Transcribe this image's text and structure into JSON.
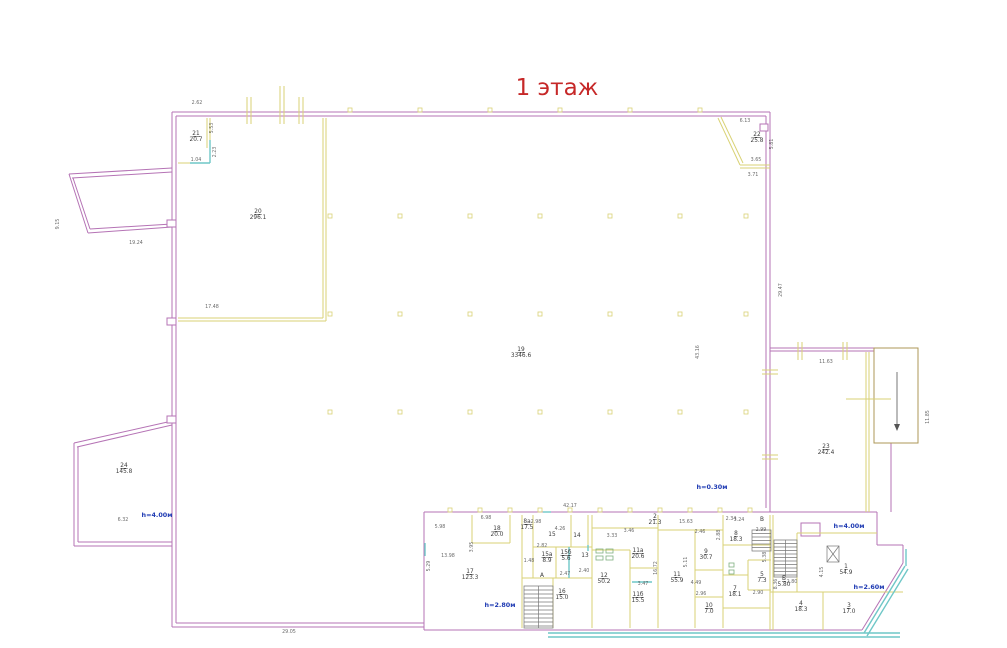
{
  "title": "1 этаж",
  "colors": {
    "title": "#c62828",
    "walls_outer": "#b573b5",
    "walls_inner": "#d9d275",
    "glazing": "#6fc7c7",
    "ramp": "#ad9757",
    "fixtures": "#7fb07f",
    "height_notes": "#1f3bb3",
    "dimensions": "#6a6a6a"
  },
  "floor_plan": {
    "rooms": [
      {
        "id": "19",
        "area": "3346.6",
        "x": 521,
        "y": 351
      },
      {
        "id": "20",
        "area": "296.1",
        "x": 258,
        "y": 213
      },
      {
        "id": "21",
        "area": "20.7",
        "x": 196,
        "y": 135
      },
      {
        "id": "22",
        "area": "25.8",
        "x": 757,
        "y": 136
      },
      {
        "id": "23",
        "area": "242.4",
        "x": 826,
        "y": 448
      },
      {
        "id": "24",
        "area": "145.8",
        "x": 124,
        "y": 467
      },
      {
        "id": "17",
        "area": "123.3",
        "x": 470,
        "y": 573
      },
      {
        "id": "18",
        "area": "20.0",
        "x": 497,
        "y": 530
      },
      {
        "id": "8а",
        "area": "17.5",
        "x": 527,
        "y": 523
      },
      {
        "id": "15",
        "area": "",
        "x": 552,
        "y": 536
      },
      {
        "id": "14",
        "area": "",
        "x": 577,
        "y": 537
      },
      {
        "id": "15а",
        "area": "8.9",
        "x": 547,
        "y": 556
      },
      {
        "id": "15б",
        "area": "5.6",
        "x": 566,
        "y": 554
      },
      {
        "id": "13",
        "area": "",
        "x": 585,
        "y": 557
      },
      {
        "id": "16",
        "area": "15.0",
        "x": 562,
        "y": 593
      },
      {
        "id": "12",
        "area": "50.2",
        "x": 604,
        "y": 577
      },
      {
        "id": "11б",
        "area": "15.5",
        "x": 638,
        "y": 596
      },
      {
        "id": "11а",
        "area": "20.6",
        "x": 638,
        "y": 552
      },
      {
        "id": "11",
        "area": "55.9",
        "x": 677,
        "y": 576
      },
      {
        "id": "9",
        "area": "30.7",
        "x": 706,
        "y": 553
      },
      {
        "id": "10",
        "area": "7.0",
        "x": 709,
        "y": 607
      },
      {
        "id": "7",
        "area": "18.1",
        "x": 735,
        "y": 590
      },
      {
        "id": "2",
        "area": "21.3",
        "x": 655,
        "y": 518
      },
      {
        "id": "8",
        "area": "18.3",
        "x": 736,
        "y": 535
      },
      {
        "id": "5",
        "area": "7.3",
        "x": 762,
        "y": 576
      },
      {
        "id": "4",
        "area": "18.3",
        "x": 801,
        "y": 605
      },
      {
        "id": "3",
        "area": "17.0",
        "x": 849,
        "y": 607
      },
      {
        "id": "1",
        "area": "54.9",
        "x": 846,
        "y": 568
      },
      {
        "id": "А",
        "area": "",
        "x": 542,
        "y": 577
      },
      {
        "id": "Б",
        "area": "5.80",
        "x": 784,
        "y": 580
      },
      {
        "id": "В",
        "area": "",
        "x": 762,
        "y": 521
      }
    ],
    "dimensions": [
      {
        "t": "6.13",
        "x": 745,
        "y": 122
      },
      {
        "t": "5.81",
        "x": 773,
        "y": 144,
        "r": -90
      },
      {
        "t": "3.65",
        "x": 756,
        "y": 161
      },
      {
        "t": "3.71",
        "x": 753,
        "y": 176
      },
      {
        "t": "29.47",
        "x": 782,
        "y": 290,
        "r": -90
      },
      {
        "t": "11.63",
        "x": 826,
        "y": 363
      },
      {
        "t": "11.85",
        "x": 929,
        "y": 417,
        "r": -90
      },
      {
        "t": "43.16",
        "x": 699,
        "y": 352,
        "r": -90
      },
      {
        "t": "9.15",
        "x": 59,
        "y": 224,
        "r": -90
      },
      {
        "t": "19.24",
        "x": 136,
        "y": 244
      },
      {
        "t": "2.62",
        "x": 197,
        "y": 104
      },
      {
        "t": "5.53",
        "x": 213,
        "y": 128,
        "r": -90
      },
      {
        "t": "2.23",
        "x": 216,
        "y": 152,
        "r": -90
      },
      {
        "t": "1.04",
        "x": 196,
        "y": 161
      },
      {
        "t": "17.48",
        "x": 212,
        "y": 308
      },
      {
        "t": "6.32",
        "x": 123,
        "y": 521
      },
      {
        "t": "29.05",
        "x": 289,
        "y": 633
      },
      {
        "t": "42.17",
        "x": 570,
        "y": 507
      },
      {
        "t": "15.63",
        "x": 686,
        "y": 523
      },
      {
        "t": "5.29",
        "x": 430,
        "y": 566,
        "r": -90
      },
      {
        "t": "5.98",
        "x": 440,
        "y": 528
      },
      {
        "t": "6.98",
        "x": 486,
        "y": 519
      },
      {
        "t": "13.98",
        "x": 448,
        "y": 557
      },
      {
        "t": "1.48",
        "x": 529,
        "y": 562
      },
      {
        "t": "2.82",
        "x": 542,
        "y": 547
      },
      {
        "t": "4.26",
        "x": 560,
        "y": 530
      },
      {
        "t": "2.98",
        "x": 536,
        "y": 523
      },
      {
        "t": "3.33",
        "x": 612,
        "y": 537
      },
      {
        "t": "2.40",
        "x": 584,
        "y": 572
      },
      {
        "t": "2.47",
        "x": 565,
        "y": 575
      },
      {
        "t": "3.95",
        "x": 473,
        "y": 547,
        "r": -90
      },
      {
        "t": "3.46",
        "x": 629,
        "y": 532
      },
      {
        "t": "2.34",
        "x": 731,
        "y": 520
      },
      {
        "t": "3.24",
        "x": 739,
        "y": 521
      },
      {
        "t": "2.99",
        "x": 761,
        "y": 531
      },
      {
        "t": "16.72",
        "x": 657,
        "y": 568,
        "r": -90
      },
      {
        "t": "5.11",
        "x": 687,
        "y": 562,
        "r": -90
      },
      {
        "t": "3.47",
        "x": 643,
        "y": 585
      },
      {
        "t": "4.49",
        "x": 696,
        "y": 584
      },
      {
        "t": "2.96",
        "x": 701,
        "y": 595
      },
      {
        "t": "2.46",
        "x": 700,
        "y": 533
      },
      {
        "t": "2.88",
        "x": 720,
        "y": 535,
        "r": -90
      },
      {
        "t": "5.38",
        "x": 766,
        "y": 557,
        "r": -90
      },
      {
        "t": "2.90",
        "x": 758,
        "y": 594
      },
      {
        "t": "8.36",
        "x": 777,
        "y": 584,
        "r": -90
      },
      {
        "t": "2.80",
        "x": 792,
        "y": 583
      },
      {
        "t": "4.15",
        "x": 823,
        "y": 572,
        "r": -90
      }
    ],
    "notes": [
      {
        "t": "h=0.30м",
        "x": 712,
        "y": 489
      },
      {
        "t": "h=4.00м",
        "x": 157,
        "y": 517
      },
      {
        "t": "h=4.00м",
        "x": 849,
        "y": 528
      },
      {
        "t": "h=2.80м",
        "x": 500,
        "y": 607
      },
      {
        "t": "h=2.60м",
        "x": 869,
        "y": 589
      }
    ]
  }
}
